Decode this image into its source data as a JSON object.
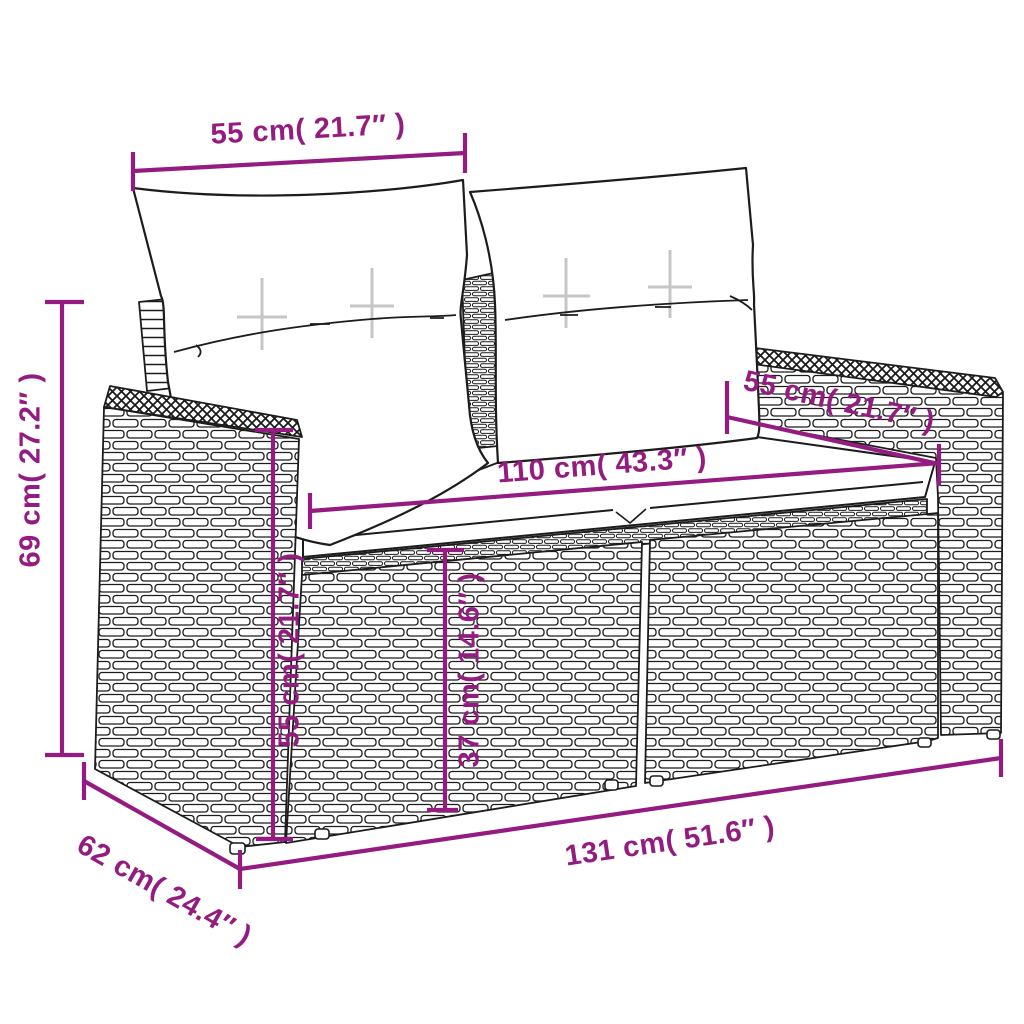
{
  "page": {
    "background": "#ffffff",
    "type": "product-dimension-diagram",
    "subject": "2-seater poly rattan garden sofa with cushions"
  },
  "colors": {
    "dimension": "#941B80",
    "line_art": "#1c1c1c",
    "cushion": "#ffffff"
  },
  "dimensions": {
    "pillow_width": {
      "text": "55 cm( 21.7″ )"
    },
    "total_height": {
      "text": "69 cm( 27.2″ )"
    },
    "back_depth": {
      "text": "55 cm( 21.7″ )"
    },
    "seat_width": {
      "text": "110 cm( 43.3″ )"
    },
    "arm_height": {
      "text": "55 cm( 21.7″ )"
    },
    "seat_height": {
      "text": "37 cm( 14.6″ )"
    },
    "total_width": {
      "text": "131 cm( 51.6″ )"
    },
    "total_depth": {
      "text": "62 cm( 24.4″ )"
    }
  }
}
